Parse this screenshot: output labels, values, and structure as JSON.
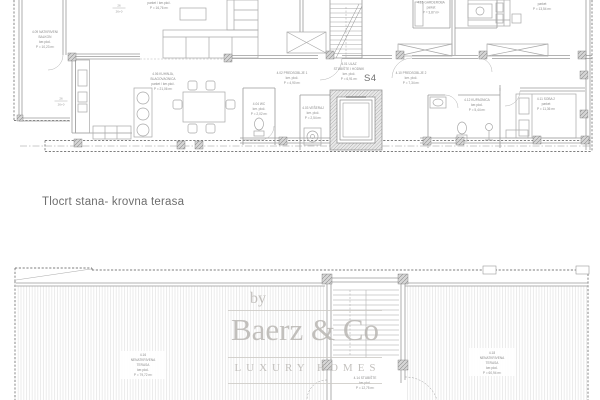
{
  "meta": {
    "drawing_title": "Tlocrt stana- krovna terasa",
    "unit_label": "S4"
  },
  "watermark": {
    "prefix": "by",
    "brand": "Baerz & Co",
    "tagline": "LUXURY HOMES"
  },
  "upper_plan": {
    "rooms": {
      "living": {
        "lines": [
          "parket / ker.ploč.",
          "P = 16,76 m²"
        ]
      },
      "balkon": {
        "lines": [
          "4.09 NATKRIVENI",
          "BALKON",
          "ker.ploč.",
          "P = 10,23 m²"
        ]
      },
      "kuhinja": {
        "lines": [
          "4.06 KUHINJA,",
          "BLAGOVAONICA",
          "parket / ker.ploč.",
          "P = 21,06 m²"
        ]
      },
      "ulaz": {
        "lines": [
          "4.01 ULAZ",
          "STUBIŠTE I HODNIK",
          "ker. ploč.",
          "P = 6,91 m²"
        ]
      },
      "predsoblje1": {
        "lines": [
          "4.02 PREDSOBLJE 1",
          "ker. ploč.",
          "P = 4,90 m²"
        ]
      },
      "wc": {
        "lines": [
          "4.04 WC",
          "ker. ploč.",
          "P = 2,02 m²"
        ]
      },
      "veseraj": {
        "lines": [
          "4.03 VEŠERAJ",
          "ker. ploč.",
          "P = 2,54 m²"
        ]
      },
      "predsoblje2": {
        "lines": [
          "4.10 PREDSOBLJE 2",
          "ker. ploč.",
          "P = 7,34 m²"
        ]
      },
      "garderoba": {
        "lines": [
          "4.15 GARDEROBA",
          "parket",
          "P = 3,87 m²"
        ]
      },
      "soba1": {
        "lines": [
          "parket",
          "P = 13,54 m²"
        ]
      },
      "soba2": {
        "lines": [
          "4.11 SOBA 2",
          "parket",
          "P = 11,36 m²"
        ]
      },
      "kupaonica": {
        "lines": [
          "4.12 KUPAONICA",
          "ker.ploč.",
          "P = 5,44 m²"
        ]
      }
    },
    "dims": [
      {
        "top": "26",
        "bottom": "26+0"
      },
      {
        "top": "26",
        "bottom": "26+0"
      }
    ]
  },
  "lower_plan": {
    "rooms": {
      "terasa_l": {
        "lines": [
          "4.16",
          "NENATKRIVENA",
          "TERASA",
          "ker.ploč.",
          "P = 79,72 m²"
        ]
      },
      "terasa_r": {
        "lines": [
          "4.18",
          "NENATKRIVENA",
          "TERASA",
          "ker.ploč.",
          "P = 60,94 m²"
        ]
      },
      "stubiste": {
        "lines": [
          "4.14 STUBIŠTE",
          "ker.ploč.",
          "P = 12,75 m²"
        ]
      }
    }
  }
}
